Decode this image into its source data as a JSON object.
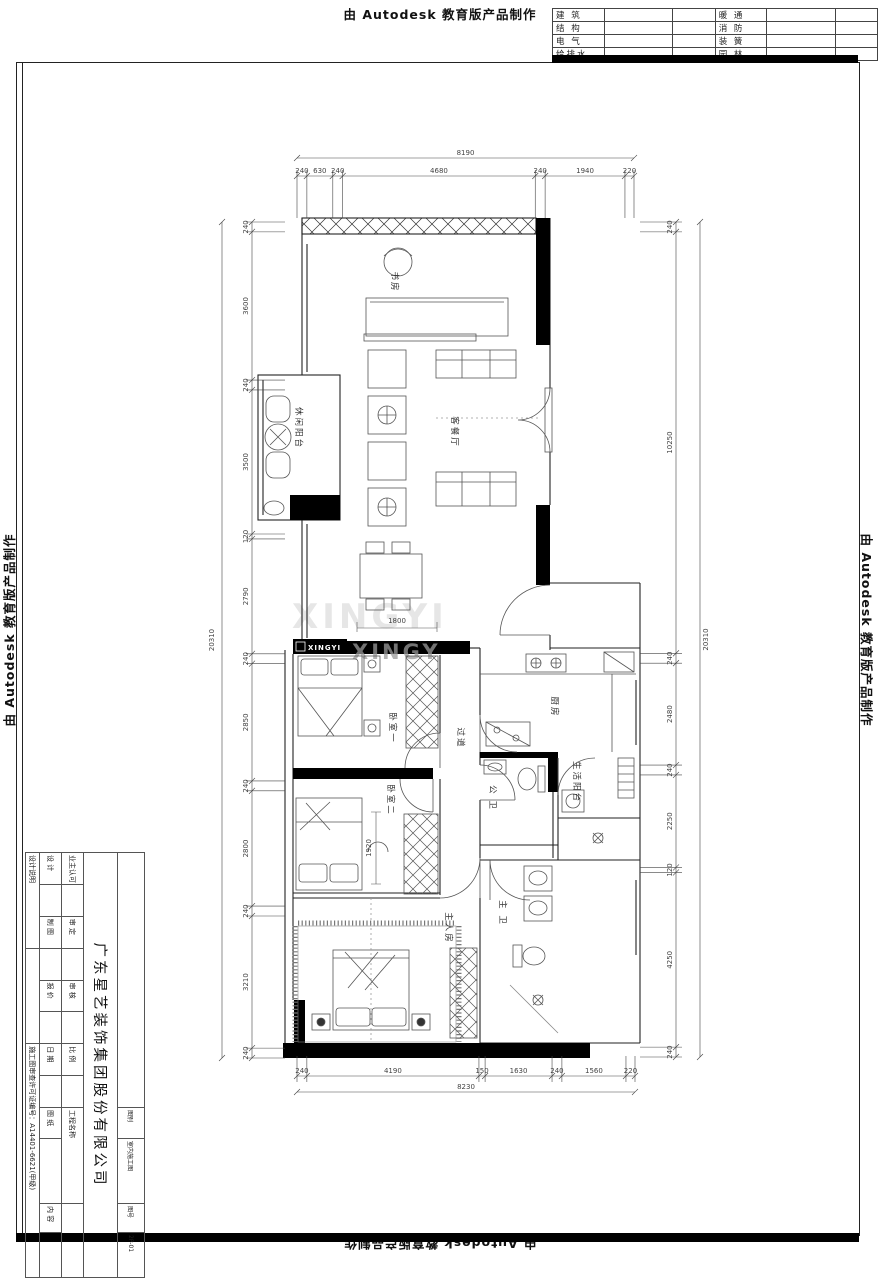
{
  "banner": {
    "top": "由 Autodesk 教育版产品制作",
    "left": "由 Autodesk 教育版产品制作",
    "right": "由 Autodesk 教育版产品制作",
    "bottom": "由 Autodesk 教育版产品制作"
  },
  "discipline_table": {
    "rows": [
      [
        "建 筑",
        "暖 通"
      ],
      [
        "结 构",
        "消 防"
      ],
      [
        "电 气",
        "装 簧"
      ],
      [
        "给排水",
        "园 林"
      ]
    ]
  },
  "plan": {
    "rooms": {
      "study": "书房",
      "living_dining": "客餐厅",
      "leisure_balcony": "休闲阳台",
      "bedroom1": "卧室一",
      "bedroom2": "卧室二",
      "master_bedroom": "主人房",
      "corridor": "过道",
      "kitchen": "厨房",
      "service_balcony": "生活阳台",
      "guest_bath": "公 卫",
      "master_bath": "主 卫"
    },
    "inner_dims": {
      "bed1_width": "1800",
      "bed2_depth": "1920"
    }
  },
  "dimensions": {
    "top": {
      "total": "8190",
      "segments": [
        240,
        630,
        240,
        4680,
        240,
        1940,
        220
      ]
    },
    "bottom": {
      "total": "8230",
      "segments": [
        240,
        4190,
        150,
        1630,
        240,
        1560,
        220
      ]
    },
    "left": {
      "total": "20310",
      "segments": [
        240,
        3600,
        240,
        3500,
        120,
        2790,
        240,
        2850,
        240,
        2800,
        240,
        3210,
        240
      ]
    },
    "right": {
      "total": "20310",
      "segments": [
        240,
        10250,
        240,
        2480,
        240,
        2250,
        120,
        4250,
        240
      ]
    }
  },
  "watermark": {
    "badge": "XINGYI",
    "ghost_large": "XINGYI",
    "ghost_small": "XINGY"
  },
  "title_block": {
    "company": "广东星艺装饰集团股份有限公司",
    "labels": {
      "design": "设 计",
      "draft": "制 图",
      "quote": "报 价",
      "date": "日 期",
      "owner_approval": "业主认可",
      "approve": "审 定",
      "review": "审 核",
      "scale": "比 例",
      "project_name": "工程名称",
      "drawing": "图 纸",
      "content": "内 容",
      "notes": "设计说明",
      "category_label": "图别",
      "category": "室内施工图",
      "sheet_no_label": "图号",
      "sheet_no": "2P-01"
    },
    "license": "施工图审查许可证编号：A14401-6621(甲级)"
  }
}
